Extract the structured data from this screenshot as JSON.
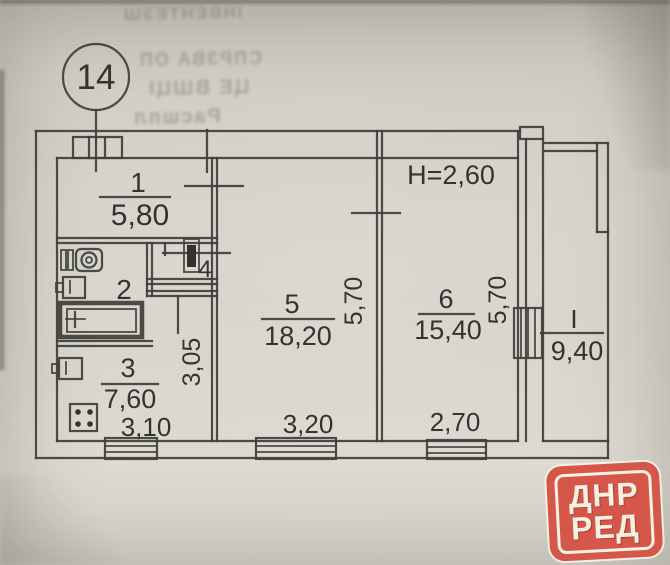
{
  "plan": {
    "bubble_number": "14",
    "ceiling_height": "Н=2,60",
    "rooms": {
      "r1": {
        "num": "1",
        "area": "5,80"
      },
      "r2": {
        "num": "2"
      },
      "r3": {
        "num": "3",
        "area": "7,60"
      },
      "r4": {
        "num": "4"
      },
      "r5": {
        "num": "5",
        "area": "18,20"
      },
      "r6": {
        "num": "6",
        "area": "15,40"
      },
      "loggia": {
        "num": "I",
        "area": "9,40"
      }
    },
    "dims": {
      "kitchen_width": "3,10",
      "kitchen_depth": "3,05",
      "room5_width": "3,20",
      "room5_depth": "5,70",
      "room6_width": "2,70",
      "room6_depth": "5,70"
    }
  },
  "watermark": {
    "line1": "ДНР",
    "line2": "РЕД"
  },
  "artifacts": {
    "bleed_line1": "ІНВЕНТЕЗШ",
    "bleed_line2": "СПРЗВА ОП",
    "bleed_line3": "ЦЕ ВШЦІ",
    "bleed_line4": "Расшпл"
  },
  "colors": {
    "logo_red": "#d5574a",
    "ink": "#403f3a",
    "paper": "#d5d2ca"
  }
}
